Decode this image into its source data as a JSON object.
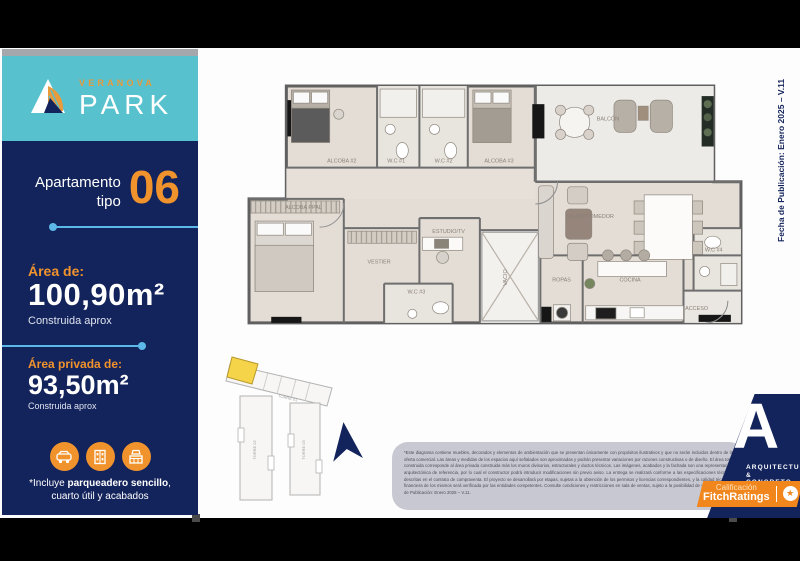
{
  "brand": {
    "top": "VERANOVA",
    "main": "PARK"
  },
  "sidebar": {
    "apartment_word": "Apartamento",
    "tipo_word": "tipo",
    "unit_number": "06",
    "area_label": "Área de:",
    "area_value": "100,90m²",
    "area_sub": "Construida aprox",
    "private_label": "Área privada de:",
    "private_value": "93,50m²",
    "private_sub": "Construida aprox",
    "note_prefix": "*Incluye ",
    "note_bold": "parqueadero sencillo",
    "note_suffix": ", cuarto útil y acabados",
    "icons": [
      "car-icon",
      "utility-closet-icon",
      "kitchen-finishes-icon"
    ]
  },
  "floorplan": {
    "rooms": [
      {
        "label": "ALCOBA #2"
      },
      {
        "label": "W.C #1"
      },
      {
        "label": "W.C #2"
      },
      {
        "label": "ALCOBA #3"
      },
      {
        "label": "BALCÓN"
      },
      {
        "label": "SALÓN/COMEDOR"
      },
      {
        "label": "ALCOBA PPAL"
      },
      {
        "label": "VESTIER"
      },
      {
        "label": "W.C #3"
      },
      {
        "label": "ESTUDIO/TV"
      },
      {
        "label": "VACIO"
      },
      {
        "label": "ROPAS"
      },
      {
        "label": "COCINA"
      },
      {
        "label": "ACCESO"
      },
      {
        "label": "W.C #4"
      }
    ]
  },
  "siteplan": {
    "towers": [
      "TORRE 01",
      "TORRE 02",
      "TORRE 03"
    ],
    "highlight_color": "#f6d44a"
  },
  "publication_note": "Fecha de Publicación: Enero 2025 – V.11",
  "footer": {
    "disclaimer": "*Este diagrama contiene muebles, decorados y elementos de ambientación que se presentan únicamente con propósitos ilustrativos y que no serán incluidos dentro de la oferta comercial. Las áreas y medidas de los espacios aquí señalados son aproximadas y podrán presentar variaciones por razones constructivas o de diseño. El área total construida corresponde al área privada construida más los muros divisorios, estructurales y ductos técnicos. Las imágenes, acabados y la fachada son una representación arquitectónica de referencia, por lo cual el constructor podrá introducir modificaciones sin previo aviso. La entrega se realizará conforme a las especificaciones técnicas descritas en el contrato de compraventa. El proyecto se desarrollará por etapas, sujetas a la obtención de los permisos y licencias correspondientes, y la calidad técnica y financiera de los mismos será verificada por las entidades competentes. Consulte condiciones y restricciones en sala de ventas, sujeto a la posibilidad de variación. Fecha de Publicación: Enero 2025 – V.11.",
    "architect_line1": "ARQUITECTURA",
    "architect_line2": "& CONCRETO",
    "architect_letter": "A",
    "rating_label": "Calificación",
    "rating_value": "FitchRatings"
  },
  "colors": {
    "teal": "#57c1cd",
    "navy": "#13235b",
    "orange": "#f0932d",
    "light_blue": "#5cb8e8",
    "fitch_orange": "#f1861c",
    "footer_gray": "#c8c8d2",
    "plan_floor": "#e3ddd5",
    "plan_wall": "#6e6e6e"
  }
}
